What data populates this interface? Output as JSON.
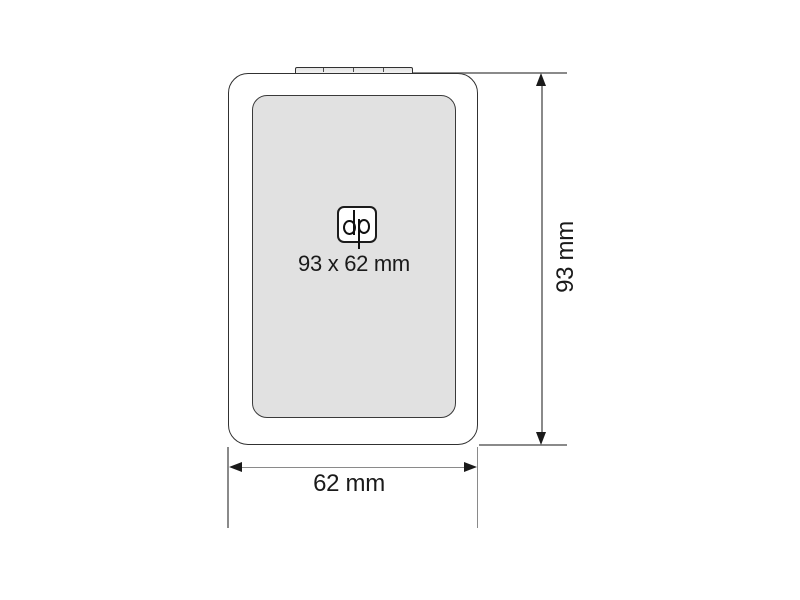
{
  "labels": {
    "print_area_size": "93 x 62 mm",
    "height_dimension": "93 mm",
    "width_dimension": "62 mm",
    "logo_text": "dp"
  },
  "colors": {
    "background": "#ffffff",
    "body_fill": "#ffffff",
    "outline": "#313131",
    "print_area_fill": "#e1e1e1",
    "dimension_line": "#8a8a8a",
    "arrowhead": "#1a1a1a",
    "text": "#1a1a1a"
  }
}
